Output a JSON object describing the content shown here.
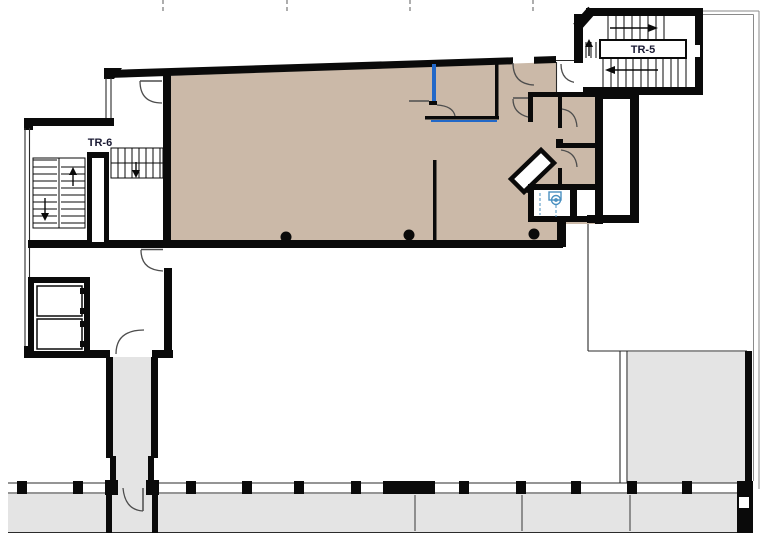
{
  "plan": {
    "labels": {
      "tr5": "TR-5",
      "tr6": "TR-6"
    },
    "colors": {
      "wall": "#0a0a0a",
      "room": "#cbb9a8",
      "paving": "#e4e4e4",
      "blue": "#2268c8",
      "fixture": "#4a90c0",
      "text": "#1a1a33",
      "tick": "#777777",
      "joint": "#555555"
    }
  }
}
